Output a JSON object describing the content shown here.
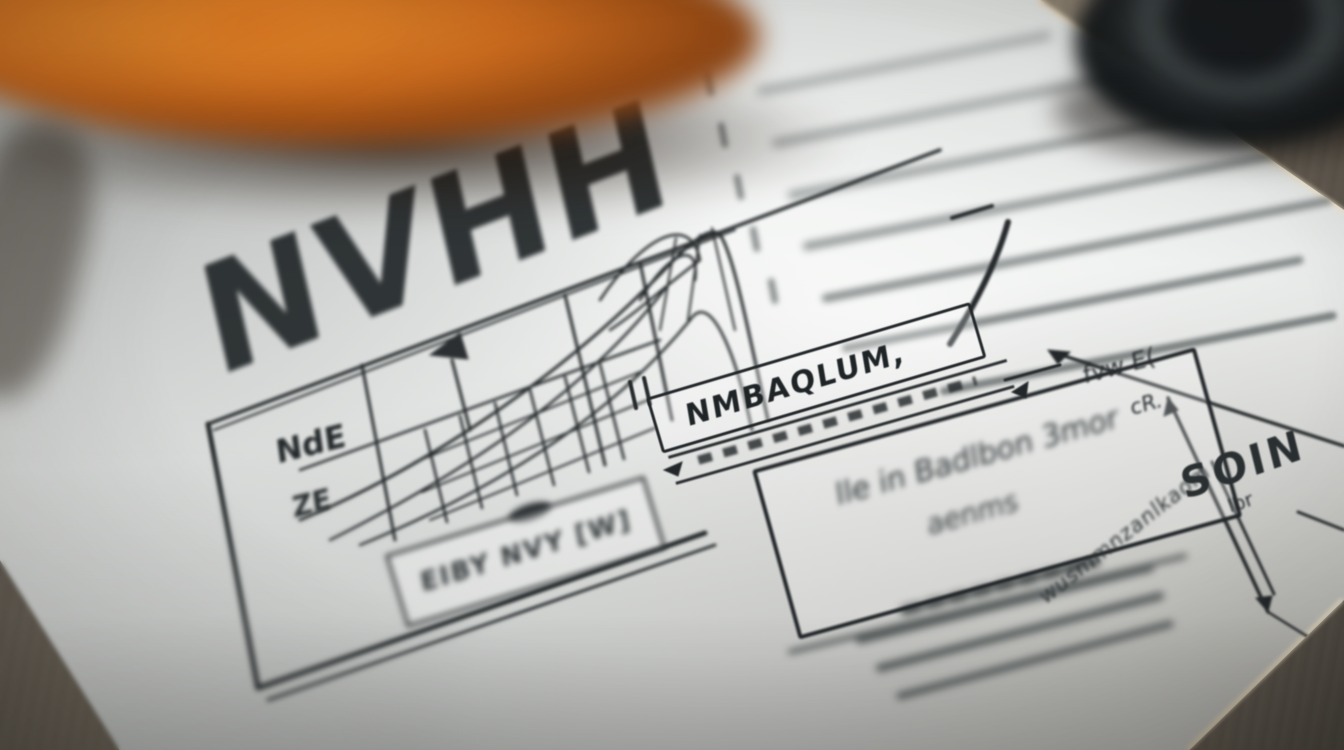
{
  "photo": {
    "title_text": "NVHH",
    "chart_panel": {
      "label_a": "NdE",
      "label_b": "ZE",
      "caption": "EIBY NVY [W]"
    },
    "header_bar": {
      "text": "NMBAQLUM,"
    },
    "note_box": {
      "line1": "lle in Badlbon 3mor",
      "line2": "aenms",
      "side_text": "wusmmnzanlkaom"
    },
    "annotations": {
      "scribble_a": "fvw E(",
      "scribble_b": "cR.",
      "label": "SOIN",
      "sublabel": "lbr"
    },
    "right_list": {
      "line_count": 7
    },
    "colors": {
      "ink": "#24282a",
      "paper": "#f1f2f1",
      "wood": "#7c7365",
      "orange": "#c8651f"
    }
  }
}
